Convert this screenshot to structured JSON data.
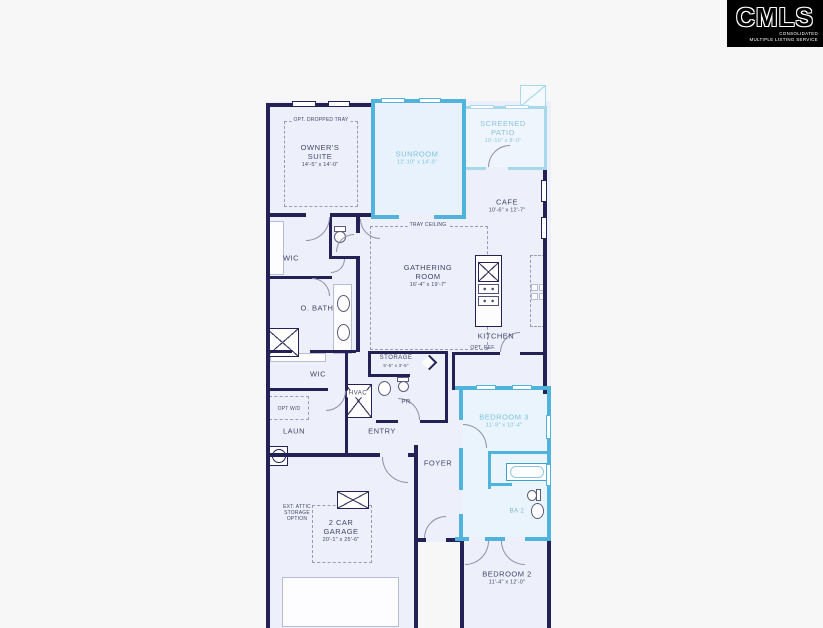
{
  "logo": {
    "name": "CMLS",
    "tagline_line1": "CONSOLIDATED",
    "tagline_line2": "MULTIPLE LISTING SERVICE"
  },
  "plan": {
    "owners_suite": {
      "name": "OWNER'S SUITE",
      "dims": "14'-5\" x 14'-0\"",
      "note": "OPT. DROPPED TRAY"
    },
    "sunroom": {
      "name": "SUNROOM",
      "dims": "12'-10\" x 14'-0\""
    },
    "screened_patio": {
      "name": "SCREENED PATIO",
      "dims": "10'-10\" x 8'-0\""
    },
    "cafe": {
      "name": "CAFE",
      "dims": "10'-6\" x 12'-7\""
    },
    "gathering_room": {
      "name": "GATHERING ROOM",
      "dims": "16'-4\" x 19'-7\"",
      "note": "TRAY CEILING"
    },
    "kitchen": {
      "name": "KITCHEN",
      "note": "OPT. REF."
    },
    "wic_upper": {
      "name": "WIC"
    },
    "owners_bath": {
      "name": "O. BATH"
    },
    "wic_lower": {
      "name": "WIC"
    },
    "storage": {
      "name": "STORAGE",
      "dims": "5'-5\" x 3'-5\""
    },
    "hvac": {
      "name": "HVAC"
    },
    "powder_room": {
      "name": "PR"
    },
    "entry": {
      "name": "ENTRY"
    },
    "laundry": {
      "name": "LAUN",
      "note": "OPT W/D"
    },
    "foyer": {
      "name": "FOYER"
    },
    "bedroom_3": {
      "name": "BEDROOM 3",
      "dims": "11'-9\" x 10'-4\""
    },
    "bath_2": {
      "name": "BA 2"
    },
    "bedroom_2": {
      "name": "BEDROOM 2",
      "dims": "11'-4\" x 12'-0\""
    },
    "garage": {
      "name": "2 CAR GARAGE",
      "dims": "20'-1\" x 25'-6\"",
      "note": "EXT. ATTIC STORAGE OPTION"
    }
  },
  "colors": {
    "background": "#f7f7f8",
    "floor": "#edf0fa",
    "wall": "#232156",
    "highlight_wall": "#4fb3dc",
    "patio_wall": "#a8d8ec",
    "label": "#44446b",
    "highlight_label": "#7cc3e0",
    "logo_bg": "#000000",
    "logo_text": "#ffffff"
  }
}
